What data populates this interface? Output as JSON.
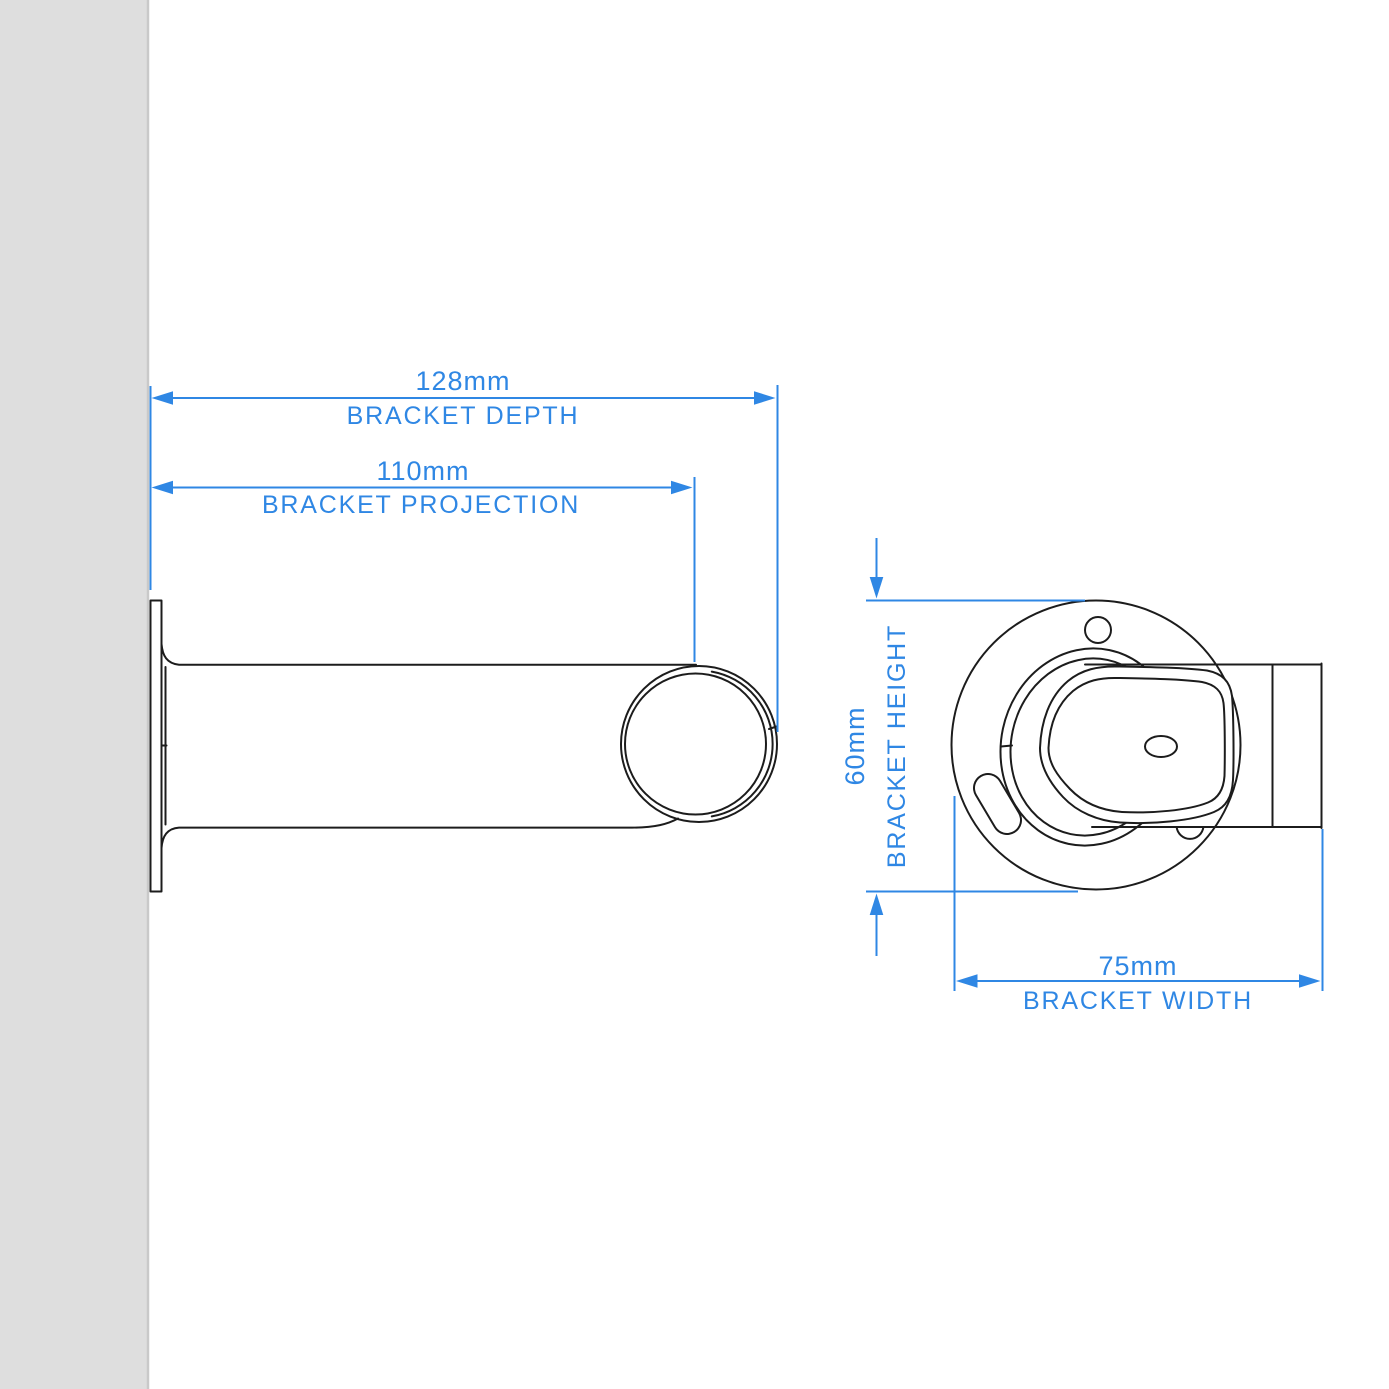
{
  "colors": {
    "accent_blue": "#2f87e4",
    "outline_black": "#1c1c1c",
    "wall_fill": "#dedede",
    "wall_edge": "#c9c9c9",
    "background": "#ffffff"
  },
  "dims": {
    "depth": {
      "value": "128mm",
      "label": "BRACKET DEPTH"
    },
    "projection": {
      "value": "110mm",
      "label": "BRACKET PROJECTION"
    },
    "height": {
      "value": "60mm",
      "label": "BRACKET HEIGHT"
    },
    "width": {
      "value": "75mm",
      "label": "BRACKET WIDTH"
    }
  }
}
